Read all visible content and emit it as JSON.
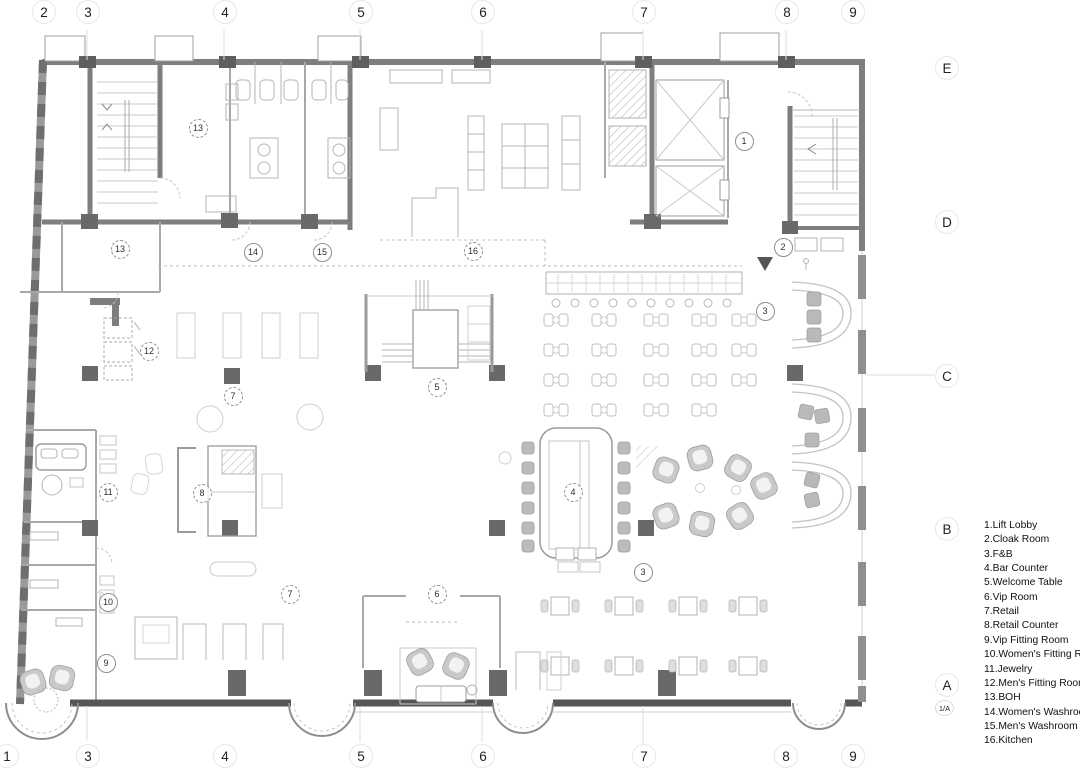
{
  "title": "Floor plan with keyed room legend",
  "colors": {
    "wall": "#7e7e7e",
    "dark_wall": "#565656",
    "column": "#696969",
    "thin_line": "#c9c9c9",
    "furniture_gray": "#c4c4c4",
    "text": "#1c1c1c"
  },
  "grid": {
    "top": [
      {
        "label": "2",
        "x": 43
      },
      {
        "label": "3",
        "x": 87
      },
      {
        "label": "4",
        "x": 224
      },
      {
        "label": "5",
        "x": 360
      },
      {
        "label": "6",
        "x": 482
      },
      {
        "label": "7",
        "x": 643
      },
      {
        "label": "8",
        "x": 786
      },
      {
        "label": "9",
        "x": 852
      }
    ],
    "bottom": [
      {
        "label": "1",
        "x": 6
      },
      {
        "label": "3",
        "x": 87
      },
      {
        "label": "4",
        "x": 224
      },
      {
        "label": "5",
        "x": 360
      },
      {
        "label": "6",
        "x": 482
      },
      {
        "label": "7",
        "x": 643
      },
      {
        "label": "8",
        "x": 785
      },
      {
        "label": "9",
        "x": 852
      }
    ],
    "rows": [
      {
        "label": "E",
        "y": 67
      },
      {
        "label": "D",
        "y": 221
      },
      {
        "label": "C",
        "y": 375
      },
      {
        "label": "B",
        "y": 528
      },
      {
        "label": "A",
        "y": 684
      }
    ],
    "row_extra": {
      "label": "1/A",
      "y": 707
    }
  },
  "balloons": [
    {
      "num": "1",
      "x": 744,
      "y": 141,
      "style": "solid"
    },
    {
      "num": "2",
      "x": 783,
      "y": 247,
      "style": "solid"
    },
    {
      "num": "3",
      "x": 765,
      "y": 311,
      "style": "solid"
    },
    {
      "num": "3",
      "x": 643,
      "y": 572,
      "style": "solid"
    },
    {
      "num": "4",
      "x": 573,
      "y": 492,
      "style": "dashed"
    },
    {
      "num": "5",
      "x": 437,
      "y": 387,
      "style": "dashed"
    },
    {
      "num": "6",
      "x": 437,
      "y": 594,
      "style": "dashed"
    },
    {
      "num": "7",
      "x": 233,
      "y": 396,
      "style": "dashed"
    },
    {
      "num": "7",
      "x": 290,
      "y": 594,
      "style": "dashed"
    },
    {
      "num": "8",
      "x": 202,
      "y": 493,
      "style": "dashed"
    },
    {
      "num": "9",
      "x": 106,
      "y": 663,
      "style": "solid"
    },
    {
      "num": "10",
      "x": 108,
      "y": 602,
      "style": "solid"
    },
    {
      "num": "11",
      "x": 108,
      "y": 492,
      "style": "dashed"
    },
    {
      "num": "12",
      "x": 149,
      "y": 351,
      "style": "dashed"
    },
    {
      "num": "13",
      "x": 198,
      "y": 128,
      "style": "dashed"
    },
    {
      "num": "13",
      "x": 120,
      "y": 249,
      "style": "dashed"
    },
    {
      "num": "14",
      "x": 253,
      "y": 252,
      "style": "solid"
    },
    {
      "num": "15",
      "x": 322,
      "y": 252,
      "style": "solid"
    },
    {
      "num": "16",
      "x": 473,
      "y": 251,
      "style": "dashed"
    }
  ],
  "legend": {
    "items": [
      "1.Lift Lobby",
      "2.Cloak Room",
      "3.F&B",
      "4.Bar Counter",
      "5.Welcome Table",
      "6.Vip Room",
      "7.Retail",
      "8.Retail Counter",
      "9.Vip Fitting Room",
      "10.Women's Fitting Room",
      "11.Jewelry",
      "12.Men's Fitting Room",
      "13.BOH",
      "14.Women's Washroom",
      "15.Men's Washroom",
      "16.Kitchen"
    ]
  }
}
